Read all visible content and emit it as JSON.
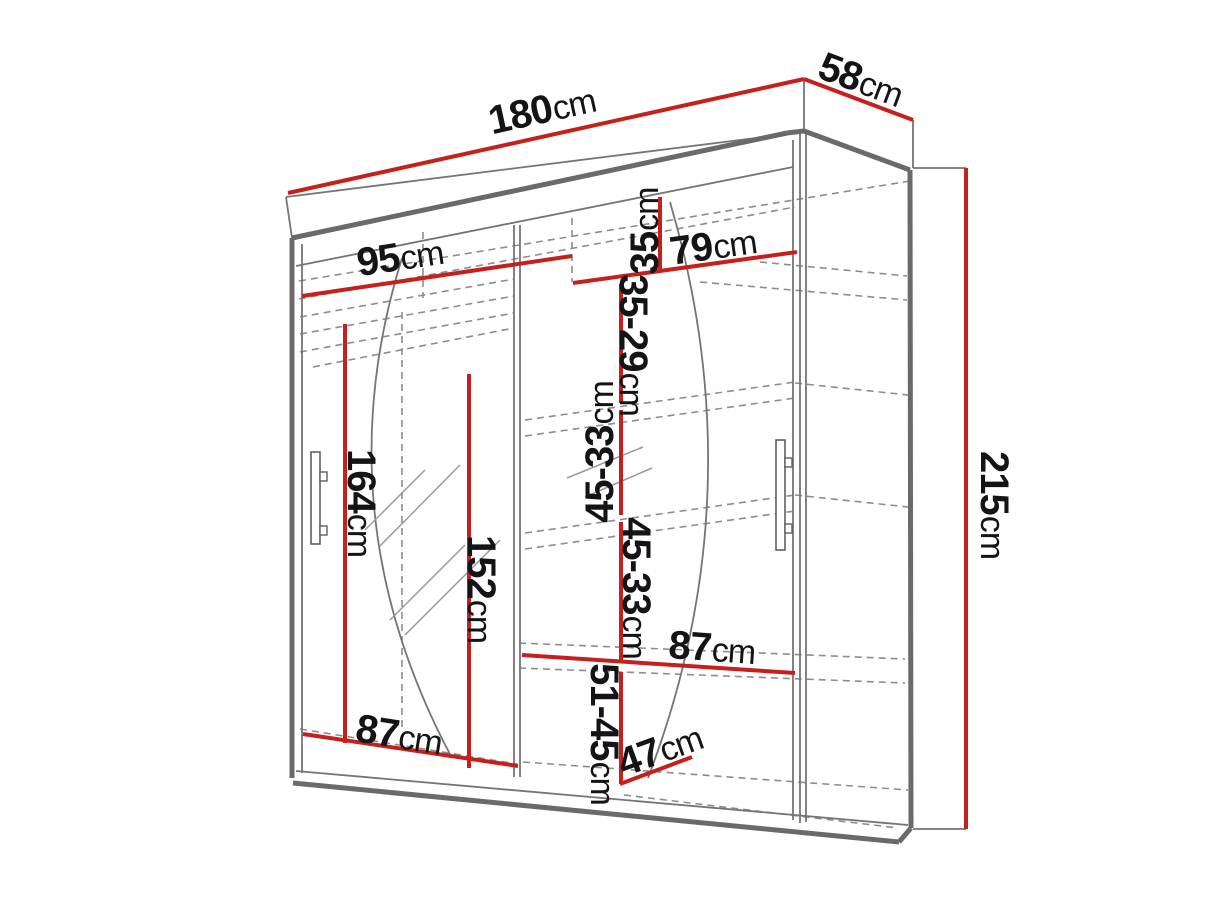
{
  "diagram": {
    "title": "wardrobe-dimension-diagram",
    "canvas": {
      "width": 1213,
      "height": 910,
      "background": "#ffffff"
    },
    "colors": {
      "dimension_line": "#c6201d",
      "outline_thick": "#6a6a6a",
      "outline_thin": "#757575",
      "dashed": "#8d8d8d",
      "label_text": "#141414",
      "handle": "#5f5f5f"
    },
    "labels": [
      {
        "id": "width-180",
        "value": "180",
        "unit": "cm",
        "x": 542,
        "y": 110,
        "rotate": -12.5
      },
      {
        "id": "depth-58",
        "value": "58",
        "unit": "cm",
        "x": 861,
        "y": 80,
        "rotate": 20.5
      },
      {
        "id": "height-215",
        "value": "215",
        "unit": "cm",
        "x": 994,
        "y": 505,
        "rotate": 90
      },
      {
        "id": "shelf-width-95",
        "value": "95",
        "unit": "cm",
        "x": 400,
        "y": 257,
        "rotate": -8.4
      },
      {
        "id": "shelf-width-79",
        "value": "79",
        "unit": "cm",
        "x": 713,
        "y": 246,
        "rotate": -8
      },
      {
        "id": "gap-35",
        "value": "35",
        "unit": "cm",
        "x": 645,
        "y": 231,
        "rotate": -90
      },
      {
        "id": "gap-35-29",
        "value": "35-29",
        "unit": "cm",
        "x": 633,
        "y": 345,
        "rotate": 90
      },
      {
        "id": "gap-45-33-upper",
        "value": "45-33",
        "unit": "cm",
        "x": 600,
        "y": 452,
        "rotate": -90
      },
      {
        "id": "gap-45-33-lower",
        "value": "45-33",
        "unit": "cm",
        "x": 636,
        "y": 588,
        "rotate": 90
      },
      {
        "id": "gap-51-45",
        "value": "51-45",
        "unit": "cm",
        "x": 604,
        "y": 734,
        "rotate": 90
      },
      {
        "id": "hang-height-164",
        "value": "164",
        "unit": "cm",
        "x": 361,
        "y": 503,
        "rotate": 90
      },
      {
        "id": "hang-height-152",
        "value": "152",
        "unit": "cm",
        "x": 481,
        "y": 589,
        "rotate": 90
      },
      {
        "id": "shelf-width-87-right",
        "value": "87",
        "unit": "cm",
        "x": 712,
        "y": 648,
        "rotate": 4
      },
      {
        "id": "shelf-width-87-left",
        "value": "87",
        "unit": "cm",
        "x": 399,
        "y": 735,
        "rotate": 9
      },
      {
        "id": "depth-47",
        "value": "47",
        "unit": "cm",
        "x": 660,
        "y": 750,
        "rotate": -20
      }
    ],
    "red_lines": [
      [
        288,
        193,
        804,
        79
      ],
      [
        804,
        79,
        913,
        120
      ],
      [
        966,
        168,
        966,
        829
      ],
      [
        302,
        296,
        572,
        256
      ],
      [
        573,
        283,
        797,
        252
      ],
      [
        660,
        197,
        660,
        271
      ],
      [
        621,
        284,
        621,
        403
      ],
      [
        621,
        410,
        621,
        515
      ],
      [
        621,
        522,
        621,
        660
      ],
      [
        621,
        672,
        621,
        784
      ],
      [
        522,
        655,
        795,
        673
      ],
      [
        303,
        734,
        518,
        766
      ],
      [
        620,
        784,
        692,
        757
      ],
      [
        345,
        324,
        345,
        743
      ],
      [
        469,
        374,
        469,
        768
      ]
    ],
    "thick_lines": [
      [
        292,
        238,
        787,
        133
      ],
      [
        787,
        133,
        804,
        131
      ],
      [
        804,
        131,
        910,
        170
      ],
      [
        910,
        170,
        911,
        828
      ],
      [
        292,
        238,
        292,
        778
      ],
      [
        293,
        783,
        899,
        842
      ],
      [
        899,
        842,
        911,
        828
      ]
    ],
    "thin_lines": [
      [
        286,
        197,
        804,
        132
      ],
      [
        286,
        197,
        292,
        238
      ],
      [
        804,
        79,
        804,
        132
      ],
      [
        913,
        120,
        913,
        168
      ],
      [
        913,
        168,
        966,
        168
      ],
      [
        913,
        829,
        966,
        829
      ],
      [
        296,
        266,
        793,
        167
      ],
      [
        793,
        140,
        793,
        820
      ],
      [
        800,
        133,
        800,
        823
      ],
      [
        806,
        134,
        806,
        822
      ],
      [
        514,
        225,
        514,
        777
      ],
      [
        520,
        225,
        520,
        777
      ],
      [
        302,
        244,
        302,
        773
      ],
      [
        296,
        771,
        908,
        825
      ]
    ],
    "dashed_lines": [
      [
        299,
        281,
        910,
        181
      ],
      [
        299,
        299,
        795,
        207
      ],
      [
        300,
        317,
        514,
        279
      ],
      [
        300,
        334,
        514,
        296
      ],
      [
        300,
        352,
        514,
        313
      ],
      [
        313,
        367,
        514,
        328
      ],
      [
        423,
        232,
        423,
        298
      ],
      [
        402,
        312,
        402,
        732
      ],
      [
        572,
        218,
        572,
        282
      ],
      [
        525,
        420,
        795,
        382
      ],
      [
        525,
        436,
        795,
        398
      ],
      [
        795,
        383,
        908,
        395
      ],
      [
        525,
        533,
        795,
        495
      ],
      [
        525,
        549,
        795,
        511
      ],
      [
        795,
        495,
        908,
        507
      ],
      [
        519,
        643,
        905,
        659
      ],
      [
        519,
        668,
        905,
        683
      ],
      [
        300,
        729,
        517,
        764
      ],
      [
        523,
        762,
        908,
        790
      ],
      [
        624,
        795,
        898,
        828
      ],
      [
        760,
        262,
        907,
        276
      ],
      [
        700,
        282,
        907,
        300
      ]
    ],
    "arcs": [
      "M 402 258 Q 322 515 452 758",
      "M 670 202 Q 756 495 648 778"
    ],
    "hatches": [
      [
        365,
        530,
        425,
        470
      ],
      [
        380,
        546,
        460,
        465
      ],
      [
        390,
        620,
        465,
        545
      ],
      [
        405,
        635,
        500,
        540
      ],
      [
        567,
        478,
        643,
        447
      ],
      [
        585,
        497,
        652,
        468
      ]
    ],
    "handles": {
      "left": {
        "x": 311,
        "y": 452,
        "w": 9,
        "h": 92,
        "tabs": [
          {
            "x": 320,
            "y": 472,
            "w": 7,
            "h": 9
          },
          {
            "x": 320,
            "y": 526,
            "w": 7,
            "h": 9
          }
        ]
      },
      "right": {
        "x": 776,
        "y": 440,
        "w": 9,
        "h": 110,
        "tabs": [
          {
            "x": 785,
            "y": 458,
            "w": 7,
            "h": 9
          },
          {
            "x": 785,
            "y": 524,
            "w": 7,
            "h": 9
          }
        ]
      }
    }
  }
}
